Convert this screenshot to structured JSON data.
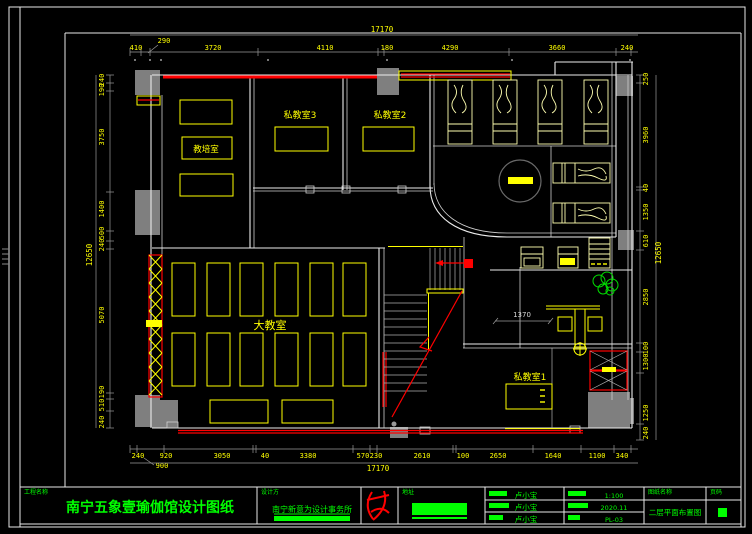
{
  "plan": {
    "rooms": {
      "training_room": "教培室",
      "private_room_3": "私教室3",
      "private_room_2": "私教室2",
      "big_classroom": "大教室",
      "private_room_1": "私教室1"
    },
    "inner_dims": {
      "desk_dim": "1370"
    },
    "dims": {
      "top": {
        "total": "17170",
        "values": [
          "410",
          "290",
          "3720",
          "4110",
          "180",
          "4290",
          "3660",
          "240"
        ]
      },
      "bottom": {
        "total": "17170",
        "leader": "900",
        "values": [
          "240",
          "920",
          "3050",
          "40",
          "3380",
          "570",
          "230",
          "2610",
          "100",
          "2650",
          "1640",
          "1100",
          "340"
        ]
      },
      "left": {
        "total": "12650",
        "values": [
          "240",
          "190",
          "3750",
          "1400",
          "500",
          "240",
          "5070",
          "190",
          "510",
          "240"
        ]
      },
      "right": {
        "total": "12650",
        "values": [
          "250",
          "3960",
          "40",
          "1350",
          "610",
          "2850",
          "100",
          "1300",
          "1250",
          "240"
        ]
      }
    }
  },
  "title_block": {
    "project_label": "工程名称",
    "project_name": "南宁五象壹瑜伽馆设计图纸",
    "designer_label": "设计方",
    "designer_name": "南宁新意为设计事务所",
    "address_label": "地址",
    "staff": [
      {
        "value": "卢小宝"
      },
      {
        "value": "卢小宝"
      },
      {
        "value": "卢小宝"
      }
    ],
    "meta": [
      {
        "value": "1:100"
      },
      {
        "value": "2020.11"
      },
      {
        "value": "PL-03"
      }
    ],
    "drawing_label": "图纸名称",
    "drawing_name": "二层平面布置图",
    "page_label": "页码"
  },
  "colors": {
    "dim_text": "#ffff00",
    "annotation": "#00ff00",
    "wall": "#ececec",
    "alert": "#ff0000",
    "column_fill": "#7f7f7f"
  }
}
